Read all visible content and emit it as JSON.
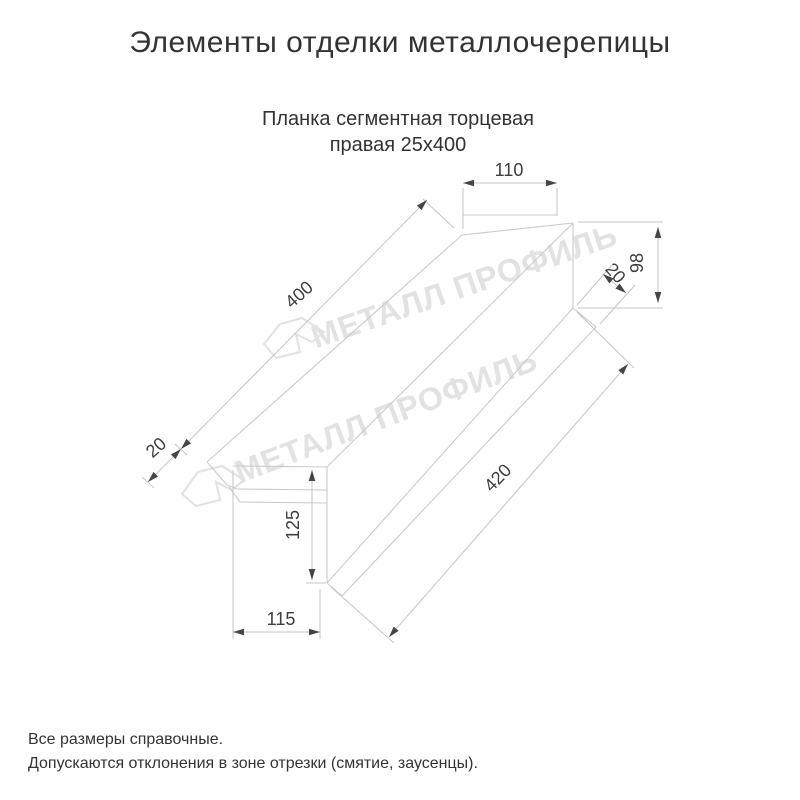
{
  "title": "Элементы отделки металлочерепицы",
  "subtitle": {
    "line1": "Планка сегментная торцевая",
    "line2": "правая 25x400"
  },
  "watermark": {
    "text": "МЕТАЛЛ ПРОФИЛЬ"
  },
  "dimensions": {
    "top_flange_width": "110",
    "right_end_height": "98",
    "right_hem_fold": "20",
    "top_edge_length": "400",
    "left_end_fold": "20",
    "left_end_height": "125",
    "bottom_offset_width": "115",
    "bottom_edge_length": "420"
  },
  "notes": {
    "line1": "Все размеры справочные.",
    "line2": "Допускаются отклонения в зоне отрезки (смятие, заусенцы)."
  },
  "colors": {
    "part_line": "#c8cbce",
    "dimension_line": "#c2c5c8",
    "dimension_text": "#3d3d3d",
    "text": "#333333",
    "watermark": "#e2e2e2"
  }
}
